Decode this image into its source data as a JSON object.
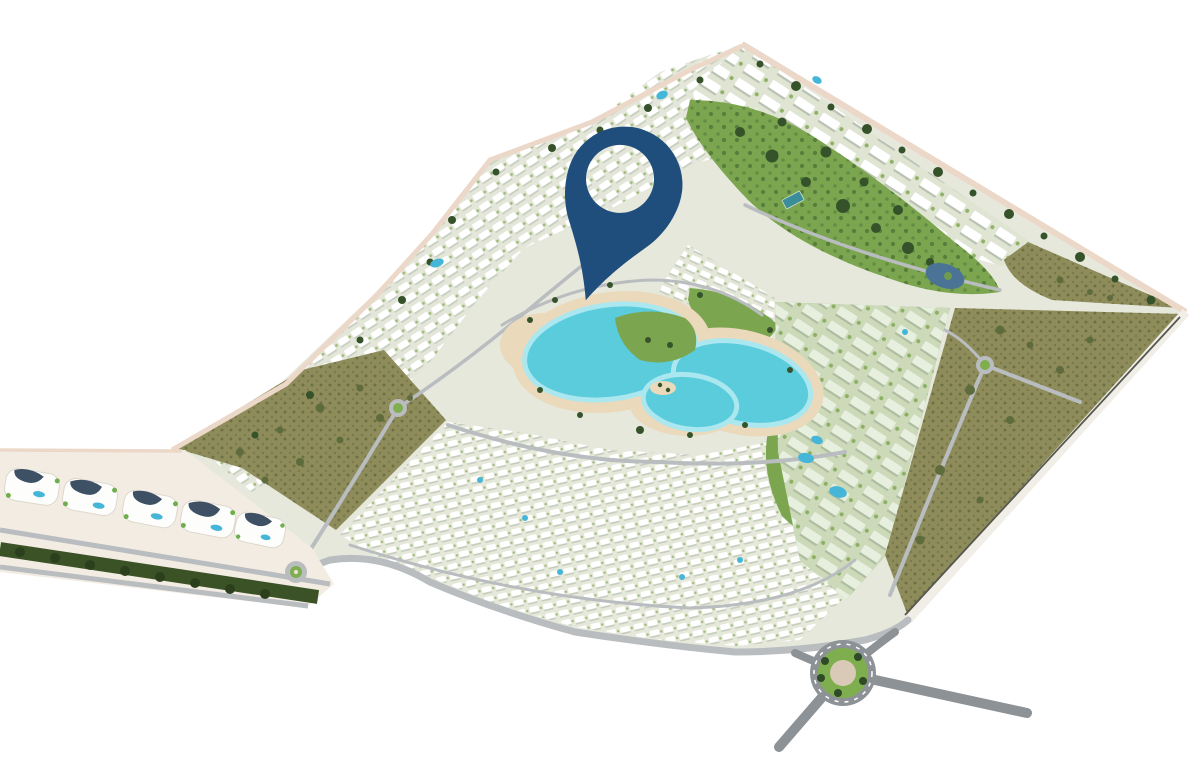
{
  "scene": {
    "kind": "aerial-masterplan-render",
    "description": "Bird's-eye 3D rendering of a kite-shaped resort master plan with a central turquoise lagoon, dense white villa and apartment clusters, olive-colored vacant plots, green parks, perimeter roads, roundabouts and a commercial boulevard strip at lower left; a large dark-blue location pin with a circular cutout marks a spot just north of the lagoon.",
    "canvas": {
      "width": 1197,
      "height": 767
    }
  },
  "colors": {
    "background": "#ffffff",
    "ground": "#e6e8dc",
    "villa_ground": "#e3e6d8",
    "olive_plot": "#8f8c5b",
    "park_green": "#7ba64f",
    "tree_dark": "#35522a",
    "strip_tree_band": "#3a5226",
    "lagoon_water": "#5accdc",
    "lagoon_shallow": "#abe7ef",
    "beach_sand": "#ead9bb",
    "road_gray": "#b9bdc0",
    "road_dark": "#8d9296",
    "road_pink": "#ecd8c9",
    "road_white": "#f1eee7",
    "strip_ground": "#f3ece3",
    "strip_roof_navy": "#3e5064",
    "pool_blue": "#45b6d8",
    "pond_blue": "#4a7396",
    "roundabout_green": "#7fae4f",
    "roundabout_center": "#d9cab7",
    "tennis_court": "#3a8d99",
    "pin": "#1f4e7d"
  },
  "pin": {
    "label": "location-marker",
    "color": "#1f4e7d",
    "transform": "translate(627,177) rotate(18.5)"
  },
  "features": [
    {
      "name": "central-lagoon",
      "kind": "swimmable crystal lagoon with beach rim and islands"
    },
    {
      "name": "villa-districts",
      "kind": "dense rows of white villas and townhouses"
    },
    {
      "name": "apartment-ridge",
      "kind": "apartment blocks with pools along the upper boundary"
    },
    {
      "name": "vacant-olive-plots",
      "kind": "undeveloped scrub parcels at left, right and corner"
    },
    {
      "name": "central-park",
      "kind": "landscaped park with pond and tennis court"
    },
    {
      "name": "commercial-boulevard",
      "kind": "retail strip with organic-roof pavilions and tree-lined road"
    },
    {
      "name": "main-roundabout",
      "kind": "large landscaped traffic circle at the south entrance"
    },
    {
      "name": "location-pin",
      "kind": "blue map marker with circular cutout"
    }
  ]
}
